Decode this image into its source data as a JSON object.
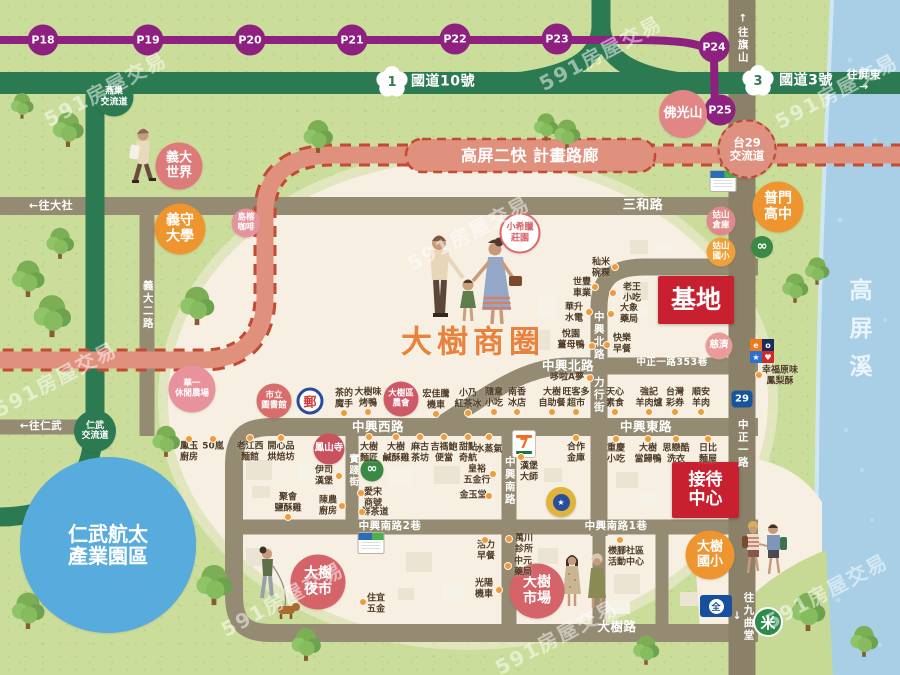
{
  "map": {
    "title": "大樹商圈",
    "river": "高屏溪"
  },
  "palette": {
    "grass": "#cbdd9b",
    "river": "#a9cfe7",
    "road": "#948b72",
    "highway_green": "#2c7a52",
    "metro_purple": "#8e2180",
    "corridor_salmon": "#e0917e",
    "corridor_dash": "#c24b36",
    "accent_red": "#c8202f",
    "poi_orange": "#ef9530",
    "poi_pink": "#d4646a",
    "cream": "#f7efe1",
    "dot_orange": "#f09a3a"
  },
  "metro": {
    "color": "#8e2180",
    "stops": [
      {
        "label": "P18",
        "x": 43,
        "y": 40
      },
      {
        "label": "P19",
        "x": 148,
        "y": 40
      },
      {
        "label": "P20",
        "x": 250,
        "y": 40
      },
      {
        "label": "P21",
        "x": 352,
        "y": 40
      },
      {
        "label": "P22",
        "x": 455,
        "y": 39
      },
      {
        "label": "P23",
        "x": 557,
        "y": 39
      },
      {
        "label": "P24",
        "x": 714,
        "y": 47
      },
      {
        "label": "P25",
        "x": 720,
        "y": 110
      }
    ]
  },
  "highways": {
    "badge1": "1",
    "no10": "國道10號",
    "badge3": "3",
    "no3": "國道3號",
    "badge29": "29",
    "corridor": "高屏二快 計畫路廊"
  },
  "road_labels": [
    {
      "id": "to-dashe",
      "text": "←往大社",
      "x": 51,
      "y": 206,
      "fs": 11
    },
    {
      "id": "sanhe-rd",
      "text": "三和路",
      "x": 643,
      "y": 206,
      "fs": 13
    },
    {
      "id": "to-renwu",
      "text": "←往仁武",
      "x": 41,
      "y": 427,
      "fs": 10.5
    },
    {
      "id": "to-kaohsiung",
      "text": "←往高雄市",
      "x": 62,
      "y": 514,
      "fs": 10.5,
      "rot": -7
    },
    {
      "id": "to-pingtung",
      "text": "往屏東→",
      "x": 864,
      "y": 81,
      "fs": 11
    },
    {
      "id": "to-qishan",
      "text": "↑往旗山",
      "x": 742,
      "y": 38,
      "fs": 10.5,
      "v": true
    },
    {
      "id": "to-jiuqutang",
      "text": "往九曲堂↓",
      "x": 742,
      "y": 617,
      "fs": 10.5,
      "v": true
    },
    {
      "id": "zhongxing-north-rd",
      "text": "中興北路",
      "x": 568,
      "y": 366,
      "fs": 12.5
    },
    {
      "id": "zhongzheng-lane-353",
      "text": "中正一路353巷",
      "x": 672,
      "y": 363,
      "fs": 9.5
    },
    {
      "id": "zhongxing-west-rd",
      "text": "中興西路",
      "x": 378,
      "y": 427,
      "fs": 12.5
    },
    {
      "id": "zhongxing-east-rd",
      "text": "中興東路",
      "x": 646,
      "y": 427,
      "fs": 12.5
    },
    {
      "id": "zhongxing-south-lane2",
      "text": "中興南路2巷",
      "x": 390,
      "y": 527,
      "fs": 10.5
    },
    {
      "id": "zhongxing-south-lane1",
      "text": "中興南路1巷",
      "x": 616,
      "y": 527,
      "fs": 10.5
    },
    {
      "id": "dashu-rd",
      "text": "大樹路",
      "x": 617,
      "y": 627,
      "fs": 12.5
    },
    {
      "id": "yida-2nd-rd",
      "text": "義大二路",
      "x": 147,
      "y": 305,
      "fs": 10.5,
      "v": true
    },
    {
      "id": "zhongxing-north-v",
      "text": "中興北路",
      "x": 598,
      "y": 336,
      "fs": 10.5,
      "v": true
    },
    {
      "id": "lixing-st",
      "text": "力行街",
      "x": 598,
      "y": 395,
      "fs": 10.5,
      "v": true
    },
    {
      "id": "shijian-st",
      "text": "實踐街",
      "x": 352,
      "y": 471,
      "fs": 9.5,
      "v": true
    },
    {
      "id": "zhongxing-south-v",
      "text": "中興南路",
      "x": 509,
      "y": 481,
      "fs": 10.5,
      "v": true
    },
    {
      "id": "zhongzheng-1st",
      "text": "中正一路",
      "x": 742,
      "y": 444,
      "fs": 10.5,
      "v": true
    },
    {
      "id": "freeway10",
      "text": "國道10號",
      "x": 443,
      "y": 82,
      "fs": 14
    },
    {
      "id": "freeway3",
      "text": "國道3號",
      "x": 806,
      "y": 81,
      "fs": 14
    },
    {
      "id": "corridor",
      "text": "高屏二快 計畫路廊",
      "x": 530,
      "y": 156,
      "fs": 16
    }
  ],
  "pois": [
    {
      "id": "eda-world",
      "text": "義大\n世界",
      "x": 179,
      "y": 166,
      "d": 47,
      "bg": "#dd7a7a",
      "fs": 13
    },
    {
      "id": "isu-university",
      "text": "義守\n大學",
      "x": 180,
      "y": 229,
      "d": 51,
      "bg": "#ef9530",
      "fs": 14
    },
    {
      "id": "niaorong-cafe",
      "text": "島榕\n咖啡",
      "x": 246,
      "y": 223,
      "d": 29,
      "bg": "#e5939c",
      "fs": 8.5
    },
    {
      "id": "huayi-farm",
      "text": "華一\n休閒農場",
      "x": 192,
      "y": 389,
      "d": 47,
      "bg": "#e8929e",
      "fs": 8.5
    },
    {
      "id": "foguangshan",
      "text": "佛光山",
      "x": 683,
      "y": 114,
      "d": 48,
      "bg": "#e28585",
      "fs": 13
    },
    {
      "id": "pumen-highschool",
      "text": "普門\n高中",
      "x": 778,
      "y": 207,
      "d": 51,
      "bg": "#ef9530",
      "fs": 14
    },
    {
      "id": "gushan-warehouse",
      "text": "姑山\n倉庫",
      "x": 721,
      "y": 221,
      "d": 29,
      "bg": "#df8a8a",
      "fs": 8.5
    },
    {
      "id": "gushan-elementary",
      "text": "姑山\n國小",
      "x": 721,
      "y": 252,
      "d": 29,
      "bg": "#efa039",
      "fs": 8.5
    },
    {
      "id": "tzu-chi",
      "text": "慈濟",
      "x": 719,
      "y": 346,
      "d": 27,
      "bg": "#eb9a9a",
      "fs": 9.5
    },
    {
      "id": "little-greece-manor",
      "text": "小希臘\n莊園",
      "x": 520,
      "y": 233,
      "d": 37,
      "bg": "#ffffff",
      "color": "#d95f63",
      "border": "2px solid #dd6a6a",
      "fs": 9
    },
    {
      "id": "city-library",
      "text": "市立\n圖書館",
      "x": 274,
      "y": 401,
      "d": 35,
      "bg": "#d96d6d",
      "fs": 8.5
    },
    {
      "id": "dashu-farmers-assoc",
      "text": "大樹區\n農會",
      "x": 401,
      "y": 399,
      "d": 35,
      "bg": "#cd5a66",
      "fs": 8.5
    },
    {
      "id": "fengshan-temple",
      "text": "鳳山寺",
      "x": 329,
      "y": 449,
      "d": 31,
      "bg": "#c8525e",
      "fs": 9.5
    },
    {
      "id": "dashu-night-market",
      "text": "大樹\n夜市",
      "x": 318,
      "y": 582,
      "d": 55,
      "bg": "#d4646a",
      "fs": 14
    },
    {
      "id": "dashu-market",
      "text": "大樹\n市場",
      "x": 537,
      "y": 591,
      "d": 55,
      "bg": "#d4646a",
      "fs": 14
    },
    {
      "id": "dashu-elementary",
      "text": "大樹\n國小",
      "x": 710,
      "y": 555,
      "d": 49,
      "bg": "#ef9530",
      "fs": 13
    },
    {
      "id": "yanchao-interchange",
      "text": "燕巢\n交流道",
      "x": 114,
      "y": 97,
      "d": 39,
      "bg": "#2c7a52",
      "fs": 9
    },
    {
      "id": "renwu-interchange",
      "text": "仁武\n交流道",
      "x": 95,
      "y": 431,
      "d": 42,
      "bg": "#2c7a52",
      "fs": 9
    },
    {
      "id": "tai29-interchange",
      "text": "台29\n交流道",
      "x": 747,
      "y": 149,
      "d": 55,
      "bg": "#df9180",
      "border": "2px dashed #b84a33",
      "fs": 11.5
    },
    {
      "id": "infinity-north",
      "text": "∞",
      "x": 762,
      "y": 247,
      "d": 22,
      "bg": "#3a8a46",
      "fs": 13
    },
    {
      "id": "infinity-west",
      "text": "∞",
      "x": 372,
      "y": 470,
      "d": 23,
      "bg": "#3a8a46",
      "fs": 13
    },
    {
      "id": "renwu-aerotech-park",
      "text": "仁武航太\n產業園區",
      "x": 108,
      "y": 545,
      "d": 176,
      "bg": "#58abdd",
      "fs": 20
    }
  ],
  "shops": [
    {
      "text": "鳳玉\n廚房",
      "x": 189,
      "y": 452,
      "dot": [
        189,
        439
      ]
    },
    {
      "text": "50嵐",
      "x": 213,
      "y": 447,
      "dot": [
        213,
        439
      ]
    },
    {
      "text": "老江西\n麵館",
      "x": 250,
      "y": 452,
      "dot": [
        250,
        438
      ]
    },
    {
      "text": "開心品\n烘焙坊",
      "x": 281,
      "y": 452,
      "dot": [
        281,
        438
      ]
    },
    {
      "text": "伊司\n漢堡",
      "x": 324,
      "y": 476,
      "dot": [
        339,
        476
      ]
    },
    {
      "text": "聚會\n鹽酥雞",
      "x": 288,
      "y": 503,
      "dot": [
        288,
        517
      ]
    },
    {
      "text": "陳農\n廚房",
      "x": 328,
      "y": 506,
      "dot": [
        342,
        506
      ]
    },
    {
      "text": "茶的\n魔手",
      "x": 344,
      "y": 399,
      "dot": [
        344,
        413
      ]
    },
    {
      "text": "大樹味\n烤鴨",
      "x": 368,
      "y": 398,
      "dot": [
        368,
        412
      ]
    },
    {
      "text": "宏佳騰\n機車",
      "x": 436,
      "y": 400,
      "dot": [
        436,
        414
      ]
    },
    {
      "text": "小乃\n紅茶冰",
      "x": 468,
      "y": 399,
      "dot": [
        468,
        413
      ]
    },
    {
      "text": "隨意\n小吃",
      "x": 494,
      "y": 398,
      "dot": [
        494,
        412
      ]
    },
    {
      "text": "南香\n冰店",
      "x": 517,
      "y": 398,
      "dot": [
        517,
        412
      ]
    },
    {
      "text": "大樹\n麵匠",
      "x": 369,
      "y": 453,
      "dot": [
        369,
        437
      ]
    },
    {
      "text": "大樹\n鹹酥雞",
      "x": 396,
      "y": 453,
      "dot": [
        396,
        437
      ]
    },
    {
      "text": "麻古\n茶坊",
      "x": 420,
      "y": 453,
      "dot": [
        420,
        437
      ]
    },
    {
      "text": "吉禡鮑\n便當",
      "x": 444,
      "y": 453,
      "dot": [
        444,
        437
      ]
    },
    {
      "text": "甜點\n奇航",
      "x": 468,
      "y": 453,
      "dot": [
        468,
        437
      ]
    },
    {
      "text": "水蒸氣",
      "x": 489,
      "y": 450,
      "dot": [
        489,
        437
      ]
    },
    {
      "text": "皇裕\n五金行",
      "x": 477,
      "y": 475,
      "dot": [
        493,
        474
      ]
    },
    {
      "text": "金玉堂",
      "x": 473,
      "y": 496,
      "dot": [
        489,
        496
      ]
    },
    {
      "text": "愛宋\n商號",
      "x": 373,
      "y": 498,
      "dot": [
        361,
        493
      ]
    },
    {
      "text": "鮮茶道",
      "x": 375,
      "y": 513,
      "dot": [
        362,
        512
      ]
    },
    {
      "text": "漢堡\n大師",
      "x": 529,
      "y": 472,
      "dot": [
        521,
        457
      ]
    },
    {
      "text": "合作\n金庫",
      "x": 576,
      "y": 453,
      "dot": [
        576,
        438
      ]
    },
    {
      "text": "重慶\n小吃",
      "x": 616,
      "y": 454,
      "dot": [
        616,
        439
      ]
    },
    {
      "text": "大樹\n當歸鴨",
      "x": 648,
      "y": 454,
      "dot": [
        648,
        439
      ]
    },
    {
      "text": "思戀酷\n洗衣",
      "x": 676,
      "y": 454,
      "dot": [
        676,
        439
      ]
    },
    {
      "text": "日比\n麵屋",
      "x": 708,
      "y": 454,
      "dot": [
        708,
        439
      ]
    },
    {
      "text": "大樹\n自助餐",
      "x": 552,
      "y": 398,
      "dot": [
        552,
        412
      ]
    },
    {
      "text": "旺客多\n超市",
      "x": 576,
      "y": 398,
      "dot": [
        576,
        412
      ]
    },
    {
      "text": "天心\n素食",
      "x": 615,
      "y": 398,
      "dot": [
        615,
        412
      ]
    },
    {
      "text": "強記\n羊肉爐",
      "x": 649,
      "y": 398,
      "dot": [
        649,
        412
      ]
    },
    {
      "text": "台灣\n彩券",
      "x": 675,
      "y": 398,
      "dot": [
        675,
        412
      ]
    },
    {
      "text": "順安\n羊肉",
      "x": 701,
      "y": 398,
      "dot": [
        701,
        412
      ]
    },
    {
      "text": "哆啦A夢",
      "x": 567,
      "y": 378,
      "dot": [
        590,
        378
      ]
    },
    {
      "text": "秈米\n碗粿",
      "x": 601,
      "y": 268,
      "dot": [
        615,
        267
      ]
    },
    {
      "text": "世豐\n車業",
      "x": 582,
      "y": 288,
      "dot": [
        595,
        287
      ]
    },
    {
      "text": "華升\n水電",
      "x": 574,
      "y": 313,
      "dot": [
        589,
        312
      ]
    },
    {
      "text": "老王\n小吃",
      "x": 632,
      "y": 293,
      "dot": [
        613,
        293
      ]
    },
    {
      "text": "大象\n藥局",
      "x": 629,
      "y": 314,
      "dot": [
        611,
        314
      ]
    },
    {
      "text": "悅園\n薑母鴨",
      "x": 571,
      "y": 340,
      "dot": [
        592,
        346
      ]
    },
    {
      "text": "快樂\n早餐",
      "x": 622,
      "y": 344,
      "dot": [
        607,
        345
      ]
    },
    {
      "text": "幸福原味\n鳳梨酥",
      "x": 780,
      "y": 376,
      "dot": [
        759,
        375
      ]
    },
    {
      "text": "住宜\n五金",
      "x": 376,
      "y": 604,
      "dot": [
        363,
        602
      ]
    },
    {
      "text": "活力\n早餐",
      "x": 486,
      "y": 551,
      "dot": [
        485,
        540
      ]
    },
    {
      "text": "光陽\n機車",
      "x": 484,
      "y": 589,
      "dot": [
        499,
        590
      ]
    },
    {
      "text": "萬川\n診所",
      "x": 524,
      "y": 544,
      "dot": [
        509,
        539
      ]
    },
    {
      "text": "中元\n藥局",
      "x": 523,
      "y": 567,
      "dot": [
        508,
        566
      ]
    },
    {
      "text": "檨腳社區\n活動中心",
      "x": 626,
      "y": 557,
      "dot": [
        620,
        540
      ]
    }
  ],
  "landmarks": {
    "site": "基地",
    "reception": "接待\n中心"
  },
  "logos": {
    "post": "郵",
    "seven": "7",
    "px": "全",
    "rice": "米",
    "police_star": "★",
    "brand_cells": [
      "e",
      "o",
      "★",
      "♥"
    ]
  },
  "watermarks": {
    "text": "591房屋交易",
    "positions": [
      [
        105,
        88
      ],
      [
        600,
        52
      ],
      [
        468,
        232
      ],
      [
        55,
        378
      ],
      [
        282,
        598
      ],
      [
        556,
        636
      ],
      [
        836,
        90
      ],
      [
        826,
        590
      ]
    ]
  }
}
